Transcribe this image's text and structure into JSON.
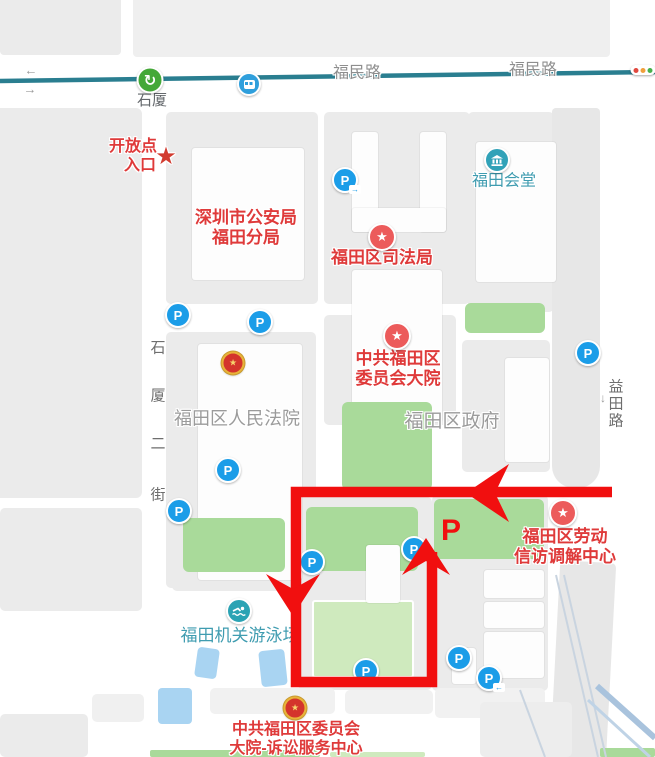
{
  "colors": {
    "route_red": "#f10f0f",
    "poi_red": "#df3a3a",
    "marker_red": "#ec5b5b",
    "metro_line": "#2a7e90",
    "park_green": "#a9da9a",
    "field_green": "#cfeabe",
    "water_blue": "#a9d4f2",
    "block_gray": "#ebebeb",
    "parking_blue": "#1b9de8",
    "teal_poi": "#3f9cb0",
    "metro_green": "#44a838",
    "bus_blue": "#2f9fdc",
    "swim_teal": "#2ba3b4",
    "hall_teal": "#31a2b8",
    "emblem_gold": "#e8b33a",
    "emblem_red": "#d4342c",
    "traffic_red": "#e0483e",
    "traffic_amber": "#f0a03c",
    "traffic_green": "#47b04b",
    "road_label_gray": "#8e8e8e",
    "poi_gray": "#9b9b9b"
  },
  "transit": {
    "station_label": "石厦",
    "road_label_left": "福民路",
    "road_label_right": "福民路"
  },
  "roads": {
    "shixia_second_street": [
      "石",
      "厦",
      "二",
      "街"
    ],
    "yitian_road": [
      "益",
      "田",
      "路"
    ]
  },
  "annotations": {
    "open_point_line1": "开放点",
    "open_point_line2": "入口",
    "open_point_star": "★",
    "parking_letter": "P",
    "labor_line1": "福田区劳动",
    "labor_line2": "信访调解中心"
  },
  "pois": {
    "police_line1": "深圳市公安局",
    "police_line2": "福田分局",
    "justice": "福田区司法局",
    "hall": "福田会堂",
    "committee_line1": "中共福田区",
    "committee_line2": "委员会大院",
    "court": "福田区人民法院",
    "government": "福田区政府",
    "pool": "福田机关游泳场",
    "litigation_line1": "中共福田区委员会",
    "litigation_line2": "大院-诉讼服务中心"
  },
  "icons": {
    "parking_label": "P",
    "star_glyph": "★",
    "emblem_glyph": "★",
    "metro_glyph": "↻",
    "down_arrow": "↓",
    "oneway_left": "←",
    "oneway_right": "→",
    "entrance_arrow_right": "→",
    "entrance_arrow_left": "←"
  }
}
